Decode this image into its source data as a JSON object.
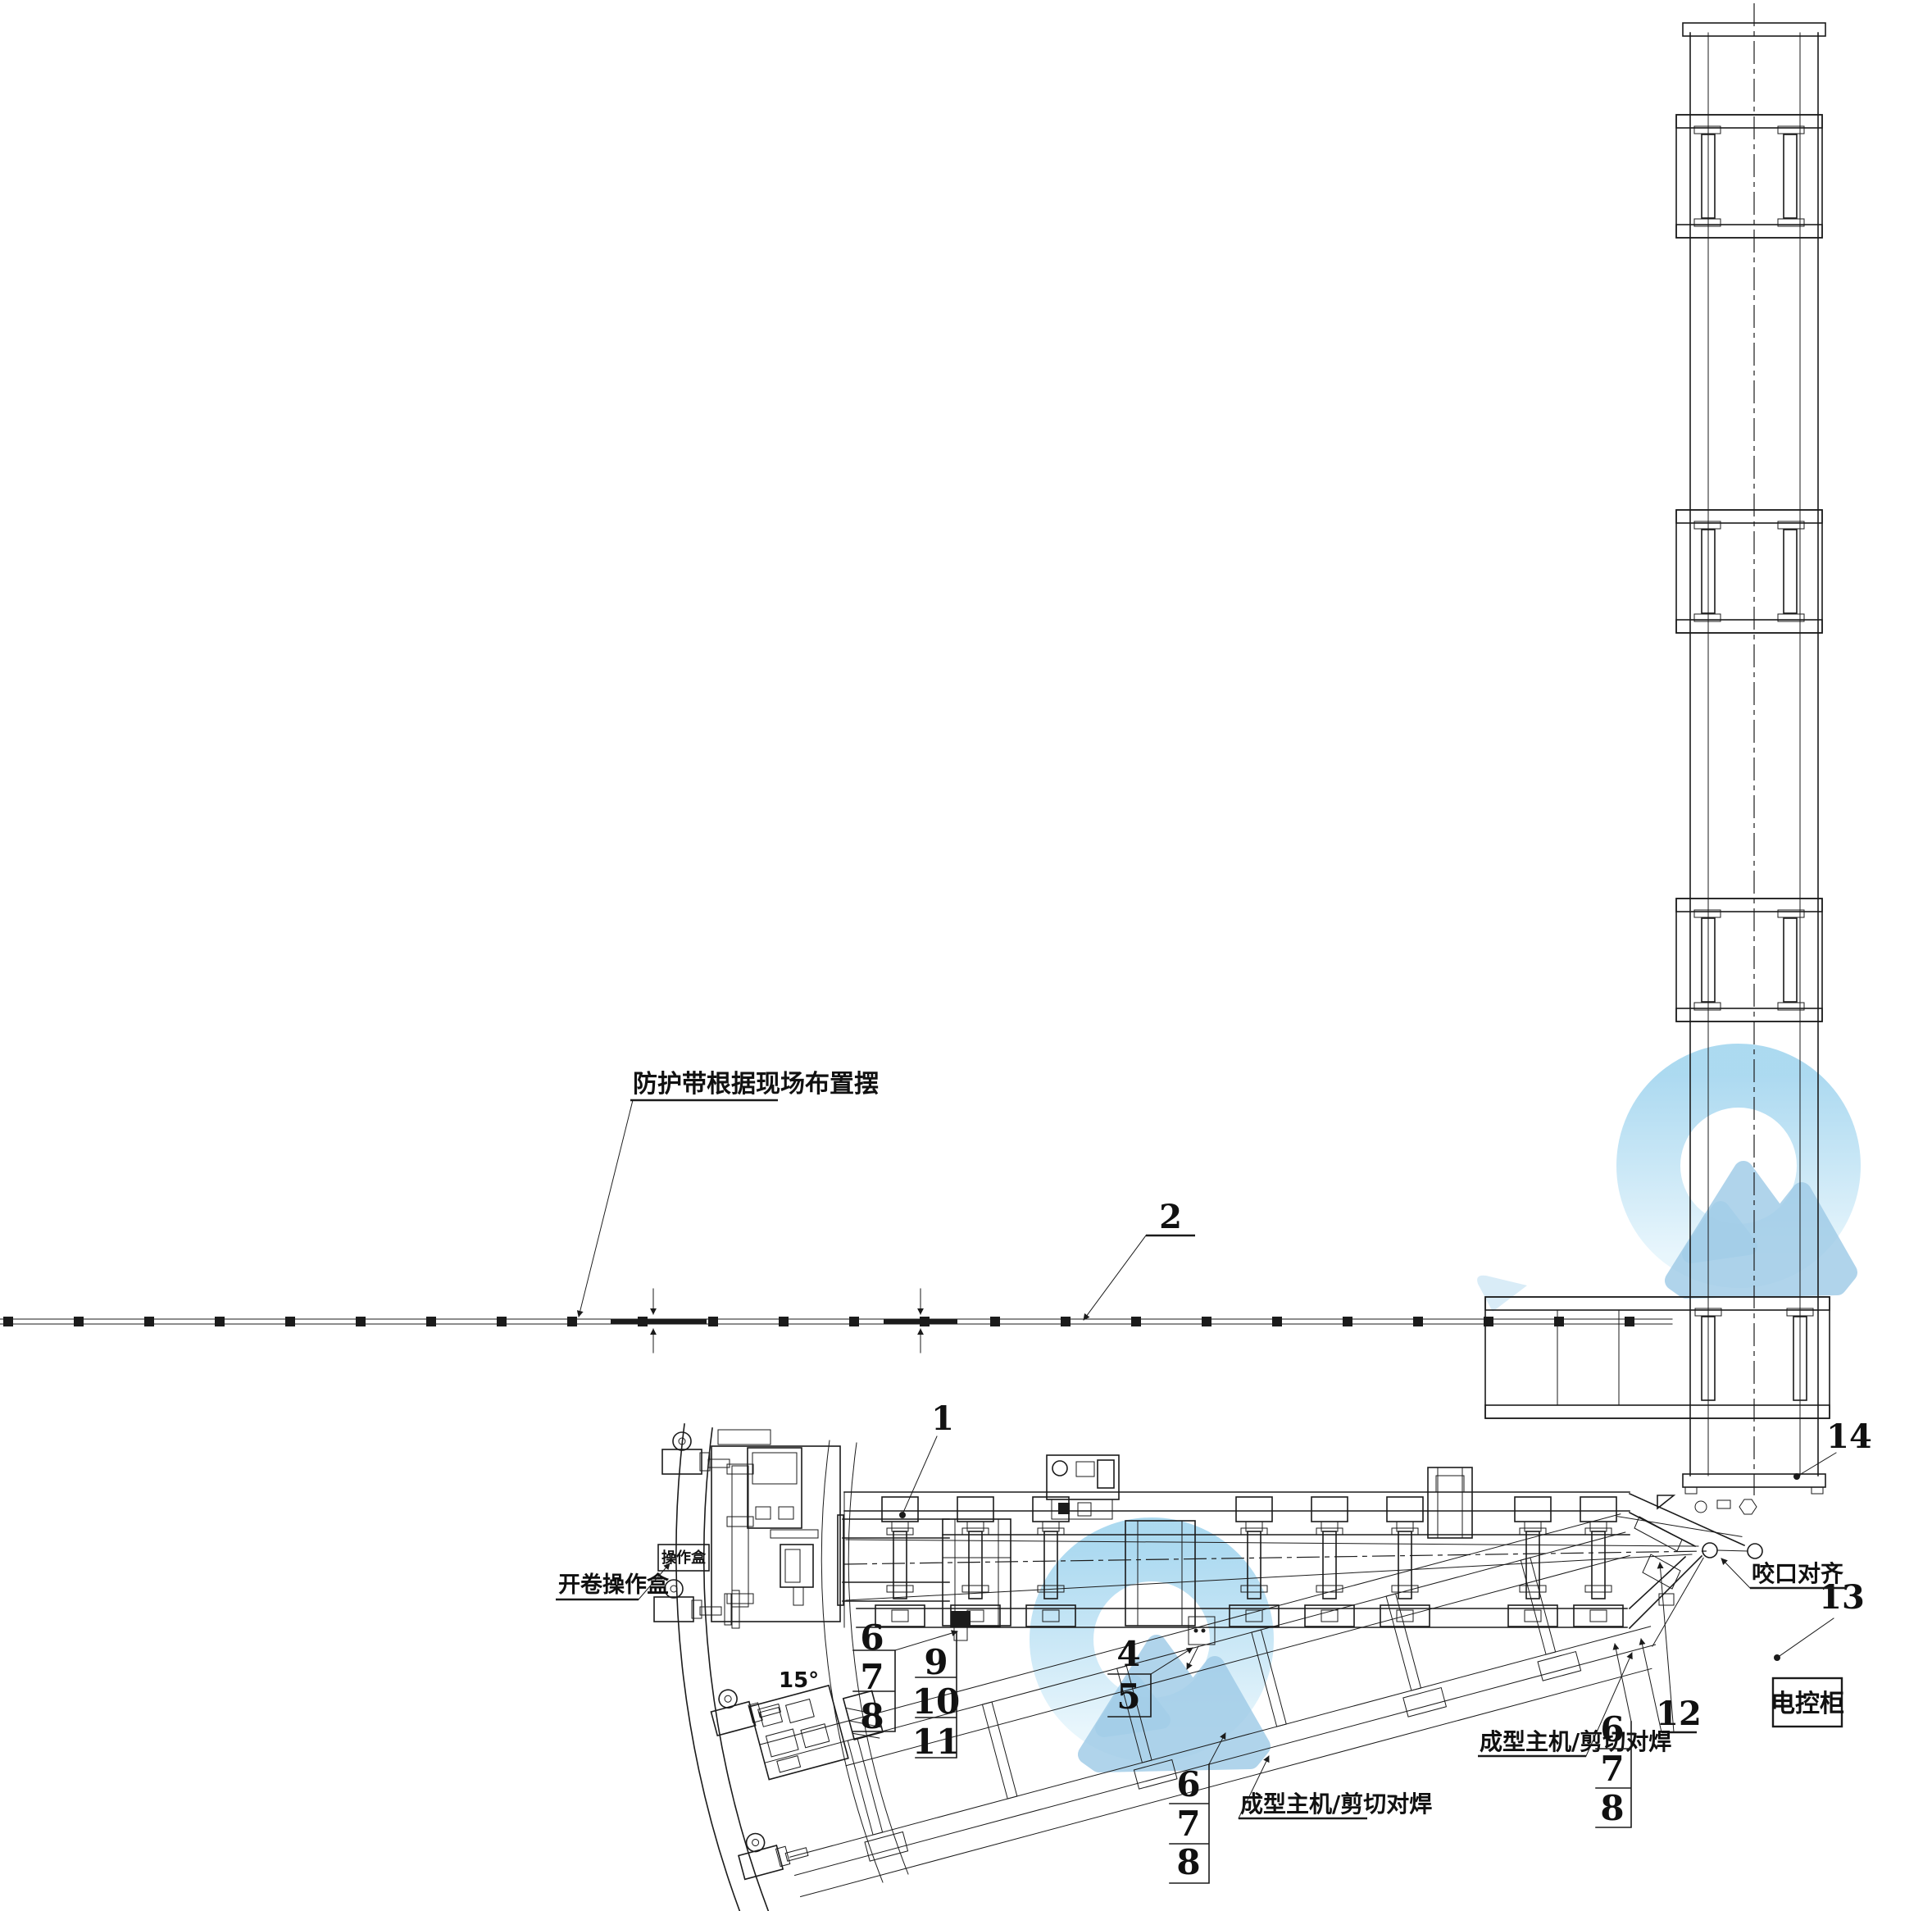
{
  "drawing": {
    "labels": {
      "belt_note": "防护带根据现场布置摆",
      "uncoiler_operator_box": "开卷操作盒",
      "operator_box": "操作盒",
      "angle_15": "15°",
      "forming_main_left": "成型主机/剪切对焊",
      "forming_main_right": "成型主机/剪切对焊",
      "bite_alignment": "咬口对齐",
      "electric_cabinet": "电控柜"
    },
    "part_numbers": {
      "p1": "1",
      "p2": "2",
      "p4": "4",
      "p5": "5",
      "p6": "6",
      "p7": "7",
      "p8": "8",
      "p9": "9",
      "p10": "10",
      "p11": "11",
      "p12": "12",
      "p13": "13",
      "p14": "14"
    },
    "colors": {
      "line": "#1b1b1b",
      "watermark_ring_top": "#9ed3ee",
      "watermark_ring_bottom": "#e6f5fc",
      "watermark_mountain": "#9fcbe7",
      "watermark_mountain_back": "#bcdff2"
    }
  }
}
